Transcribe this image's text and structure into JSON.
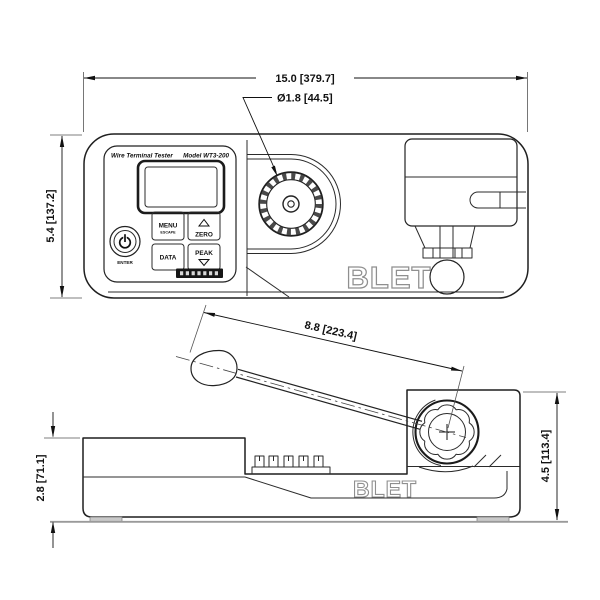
{
  "drawing": {
    "colors": {
      "line": "#1f1f1f",
      "gray_line": "#9a9a9a",
      "strip_fill": "#161616"
    },
    "dimensions": {
      "overall_width": "15.0 [379.7]",
      "dial_diameter": "Ø1.8 [44.5]",
      "body_height": "5.4 [137.2]",
      "lever_length": "8.8 [223.4]",
      "base_height": "2.8 [71.1]",
      "clamp_height": "4.5 [113.4]"
    },
    "panel": {
      "title_left": "Wire Terminal Tester",
      "title_right": "Model WT3-200",
      "buttons": {
        "menu": "MENU",
        "menu_sub": "ESCAPE",
        "zero": "ZERO",
        "data": "DATA",
        "peak": "PEAK",
        "enter": "ENTER"
      }
    },
    "brand": {
      "logo": "BLET"
    }
  }
}
